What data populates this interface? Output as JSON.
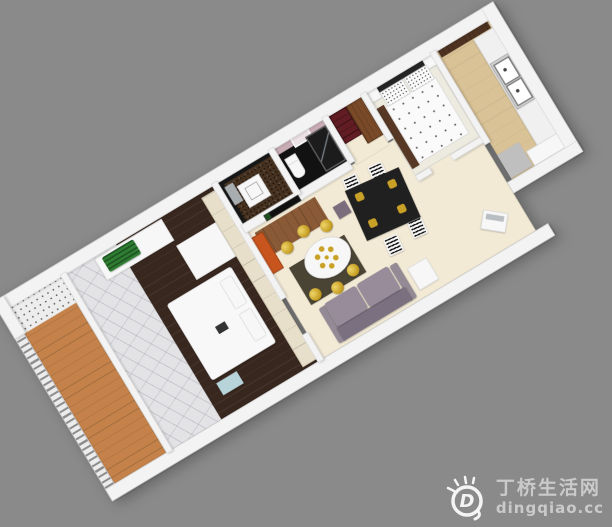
{
  "scene": {
    "description": "3D isometric cutaway floor plan of a small apartment, rotated diagonally on a flat gray background",
    "rooms": [
      {
        "name": "balcony",
        "floor": "orange wood planks",
        "items": [
          "slatted railing",
          "white speckled splash area"
        ]
      },
      {
        "name": "sunroom-corridor",
        "floor": "gray marble",
        "items": [
          "white sill cabinet",
          "green plant"
        ]
      },
      {
        "name": "master-bedroom",
        "floor": "dark brown wood",
        "items": [
          "white double bed",
          "white desk",
          "cream wardrobe",
          "light blue mat"
        ]
      },
      {
        "name": "living-dining-room",
        "floor": "cream tile",
        "items": [
          "tv partition",
          "black tv",
          "wood rug",
          "orange cabinet",
          "round white dining table",
          "six gold chairs",
          "gold chandelier",
          "dark rug",
          "black table with gold plates",
          "four striped white chairs",
          "purple ottoman",
          "gray-purple sofa",
          "white side table",
          "white laptop"
        ]
      },
      {
        "name": "utility-bathroom",
        "floor": "dark brown mosaic",
        "items": [
          "black walls",
          "white appliance",
          "steel panel"
        ]
      },
      {
        "name": "bathroom",
        "floor": "black tile",
        "items": [
          "pink walls",
          "white mirror",
          "toilet",
          "dark glass shower enclosure"
        ]
      },
      {
        "name": "entry-hall",
        "floor": "cream tile",
        "items": [
          "burgundy bookcase",
          "brown wardrobe"
        ]
      },
      {
        "name": "second-bedroom",
        "floor": "off-white",
        "items": [
          "dark headboard",
          "two white nightstands",
          "speckled pillows",
          "geometric patterned duvet",
          "dark brown rug strip"
        ]
      },
      {
        "name": "kitchen",
        "floor": "tan tile",
        "items": [
          "dark upper cabinet",
          "white counter",
          "double basin sink",
          "gray floor mat",
          "white block"
        ]
      }
    ]
  },
  "watermark": {
    "site_name": "丁桥生活网",
    "site_url": "dingqiao.cc",
    "logo_letter": "D"
  },
  "palette": {
    "bg": "#8a8a8a",
    "wall": "#f3f3f3",
    "wallEdge": "#d9d9d9",
    "balconyWood": "#c4824a",
    "marble": "#e3e3e6",
    "bedroom1Floor": "#38271e",
    "livingFloor": "#f2ead5",
    "kitchenFloor": "#d9c296",
    "utilityFloor": "#46311f",
    "bathFloor": "#121212",
    "bathWall": "#c9adb5",
    "sofaBody": "#7b7080",
    "sofaCushion": "#988c9a",
    "sofaArm": "#948a96",
    "gold": "#c9a126",
    "tableBlack": "#202020",
    "orangeCabinet": "#c8551d",
    "burgundy": "#621d24",
    "woodBrown": "#7a4a28",
    "creamWardrobe": "#e7dfca",
    "bedWhite": "#f8f8f8",
    "headboard": "#242424",
    "rugDark": "#573824",
    "blueMat": "#b7d4da",
    "plantGreen": "#2e7d32",
    "tvBlack": "#101010",
    "woodRug": "#8a5a36",
    "counterWhite": "#f0f0f0",
    "steel": "#a8adb0",
    "grayFloor": "#bfbfbf",
    "duvet": "#fafafa",
    "oliveRug": "#4a4434",
    "bedroom2Floor": "#edeadf"
  }
}
